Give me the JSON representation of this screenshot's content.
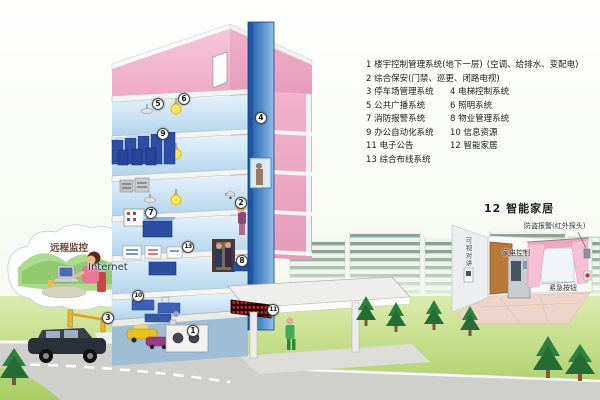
{
  "diagram": {
    "type": "smart-building-systems-diagram",
    "legend": {
      "rows": [
        {
          "left": "1 楼宇控制管理系统(地下一层)",
          "right": "(空调、给排水、变配电)"
        },
        {
          "left": "2 综合保安(门禁、巡更、闭路电视)",
          "right": ""
        },
        {
          "left": "3 停车场管理系统",
          "right": "4 电梯控制系统"
        },
        {
          "left": "5 公共广播系统",
          "right": "6 照明系统"
        },
        {
          "left": "7 消防报警系统",
          "right": "8 物业管理系统"
        },
        {
          "left": "9 办公自动化系统",
          "right": "10 信息资源"
        },
        {
          "left": "11 电子公告",
          "right": "12 智能家居"
        },
        {
          "left": "13 综合布线系统",
          "right": ""
        }
      ]
    },
    "cloud": {
      "label": "远程监控",
      "internet_label": "Internet"
    },
    "smart_home": {
      "title": "12 智能家居",
      "labels": {
        "alarm": "防盗报警(红外探头)",
        "intercom": "可视对讲",
        "appliance": "家电控制",
        "emergency": "紧急按钮"
      }
    },
    "markers": [
      {
        "num": "1",
        "x": 193,
        "y": 331
      },
      {
        "num": "2",
        "x": 241,
        "y": 203
      },
      {
        "num": "3",
        "x": 108,
        "y": 318
      },
      {
        "num": "4",
        "x": 261,
        "y": 118
      },
      {
        "num": "5",
        "x": 158,
        "y": 104
      },
      {
        "num": "6",
        "x": 184,
        "y": 99
      },
      {
        "num": "7",
        "x": 151,
        "y": 213
      },
      {
        "num": "8",
        "x": 242,
        "y": 261
      },
      {
        "num": "9",
        "x": 163,
        "y": 134
      },
      {
        "num": "10",
        "x": 138,
        "y": 296
      },
      {
        "num": "11",
        "x": 273,
        "y": 310
      },
      {
        "num": "13",
        "x": 188,
        "y": 247
      }
    ],
    "icons": [
      "speaker-icon",
      "light-bulb-icon",
      "cctv-camera-icon",
      "server-rack-icon",
      "fire-alarm-panel-icon",
      "led-display-icon",
      "barrier-gate-icon",
      "elevator-icon"
    ],
    "colors": {
      "building_pink": "#efaac6",
      "interior_blue": "#b2d4ec",
      "elevator_blue": "#1d58a6",
      "grass_green": "#acd068",
      "led_red": "#e03424",
      "legend_text": "#1c1c1c"
    }
  }
}
